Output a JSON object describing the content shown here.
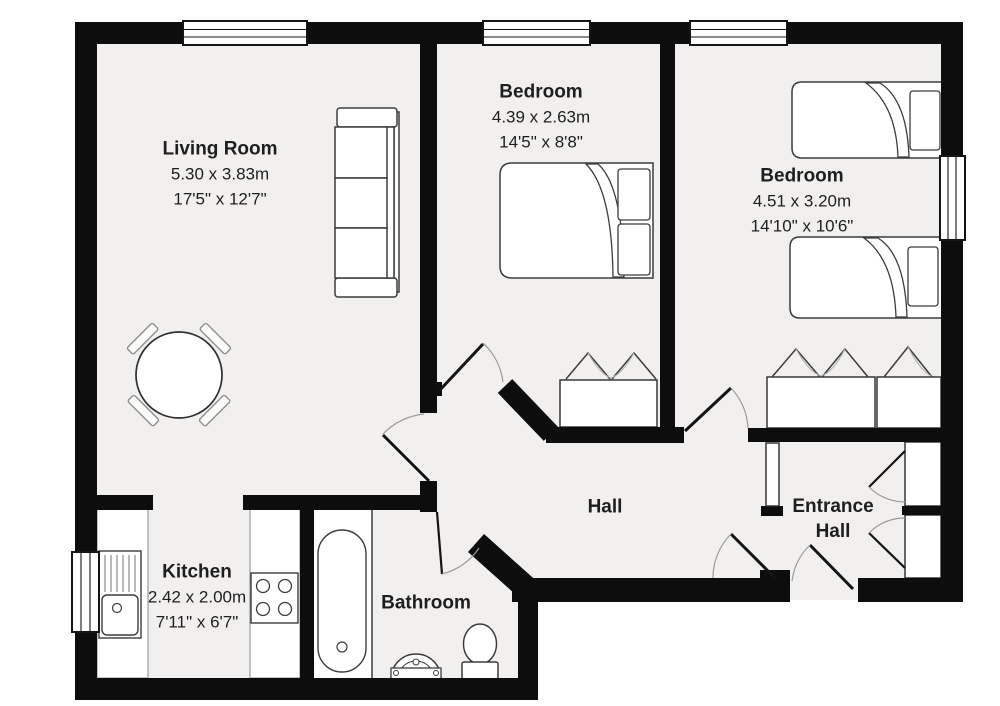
{
  "plan_title": "Two bedroom apartment floor plan",
  "colors": {
    "wall": "#0d0d0d",
    "floor": "#f1f0ee",
    "furniture_outline": "#3c3c3c",
    "door_arc": "#9a9a9a",
    "label_text": "#1e1e1e",
    "background": "#ffffff"
  },
  "rooms": {
    "living_room": {
      "name": "Living Room",
      "dim_m": "5.30 x 3.83m",
      "dim_ft": "17'5\" x 12'7\""
    },
    "bedroom_middle": {
      "name": "Bedroom",
      "dim_m": "4.39 x 2.63m",
      "dim_ft": "14'5\" x 8'8\""
    },
    "bedroom_right": {
      "name": "Bedroom",
      "dim_m": "4.51 x 3.20m",
      "dim_ft": "14'10\" x 10'6\""
    },
    "kitchen": {
      "name": "Kitchen",
      "dim_m": "2.42 x 2.00m",
      "dim_ft": "7'11\" x 6'7\""
    },
    "bathroom": {
      "name": "Bathroom"
    },
    "hall": {
      "name": "Hall"
    },
    "entrance_hall": {
      "name": "Entrance Hall"
    }
  },
  "furniture_symbols": [
    "sofa",
    "dining-table",
    "dining-chair",
    "double-bed",
    "single-bed",
    "wardrobe-closet",
    "bathtub",
    "washbasin",
    "toilet",
    "kitchen-sink",
    "kitchen-counter",
    "hob",
    "window",
    "door-swing"
  ]
}
